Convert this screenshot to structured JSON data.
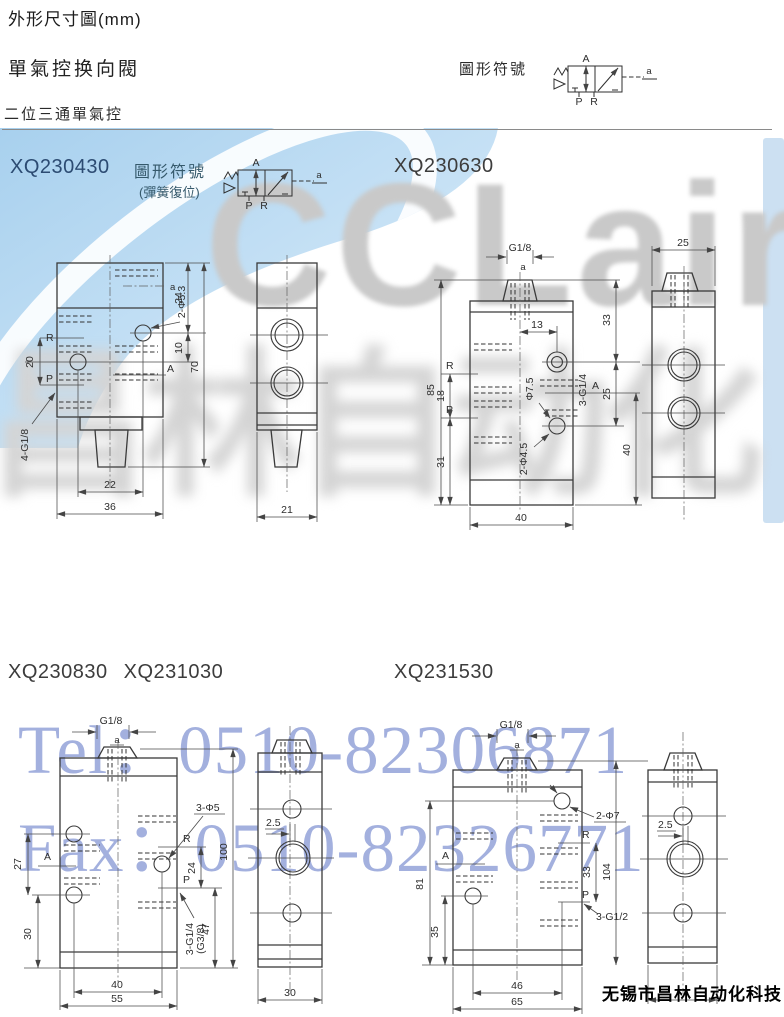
{
  "page": {
    "title": "外形尺寸圖(mm)",
    "subtitle": "單氣控换向閥",
    "section": "二位三通單氣控",
    "symbol_title": "圖形符號",
    "symbol_title2": "圖形符號",
    "symbol_note": "(彈簧復位)",
    "footer": "无锡市昌林自动化科技"
  },
  "models": {
    "m1": "XQ230430",
    "m2": "XQ230630",
    "m3": "XQ230830",
    "m4": "XQ231030",
    "m5": "XQ231530"
  },
  "ports": {
    "A": "A",
    "P": "P",
    "R": "R",
    "a": "a"
  },
  "watermarks": {
    "brand": "CCLair",
    "brand_cn": "昌林自动化",
    "tel": "Tel：0510-82306871",
    "fax": "Fax：0510-82326771",
    "blue": "#a3b0de",
    "gray": "#c9c9c9",
    "blob_blue": "#a8cfec"
  },
  "drawings": {
    "d1f": {
      "hole": "2-Φ5.3",
      "thread": "4-G1/8",
      "d24": "24",
      "d10": "10",
      "d70": "70",
      "d20": "20",
      "d22": "22",
      "d36": "36"
    },
    "d1s": {
      "d21": "21"
    },
    "d2f": {
      "g": "G1/8",
      "d13": "13",
      "d33": "33",
      "d85": "85",
      "d18": "18",
      "d31": "31",
      "d25": "25",
      "d40r": "40",
      "d40b": "40",
      "hole1": "Φ7.5",
      "hole2": "2-Φ4.5",
      "thread": "3-G1/4"
    },
    "d2s": {
      "d25": "25"
    },
    "d3f": {
      "g": "G1/8",
      "hole": "3-Φ5",
      "d24": "24",
      "thread1": "3-G1/4",
      "thread2": "(G3/8)",
      "d47": "47",
      "d100": "100",
      "d27": "27",
      "d30": "30",
      "d40": "40",
      "d55": "55"
    },
    "d3s": {
      "d25": "2.5",
      "d30": "30"
    },
    "d4f": {
      "g": "G1/8",
      "hole": "2-Φ7",
      "d33": "33",
      "d104": "104",
      "thread": "3-G1/2",
      "d81": "81",
      "d35": "35",
      "d46": "46",
      "d65": "65"
    },
    "d4s": {
      "d25": "2.5"
    }
  }
}
